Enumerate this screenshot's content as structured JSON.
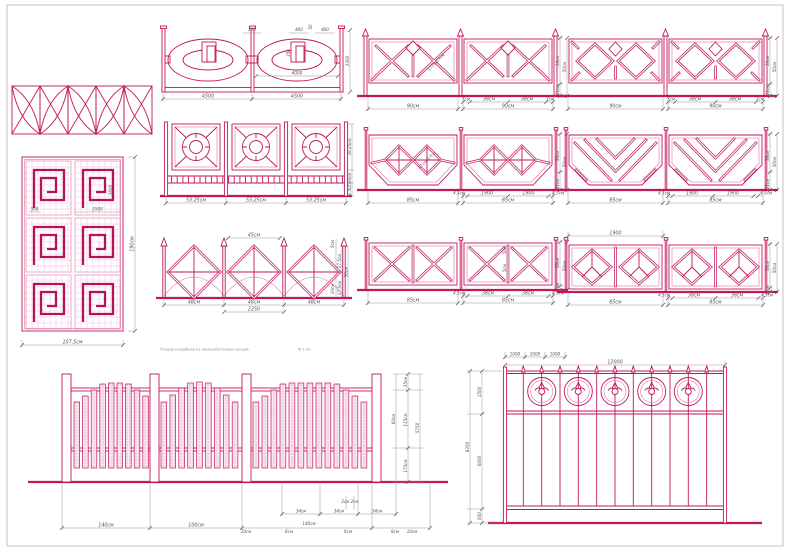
{
  "sheet": {
    "caption": "Ограда усадебная из железобетонных секций",
    "scale": "М 1:10"
  },
  "colors": {
    "primary": "#c2175b",
    "grid": "#eeadca",
    "dimension": "#56505b",
    "hatch_fill": "#dcd6da",
    "stipple_fill": "#f8e7f0"
  },
  "figures": {
    "oval": {
      "top": [
        "200",
        "400",
        "50",
        "400"
      ],
      "inner_vertical": "350",
      "inner_width": "4000",
      "right_height": "2300",
      "bottom": [
        "4500",
        "4500"
      ]
    },
    "circles": {
      "bottom": [
        "53.25см",
        "53.25см",
        "53.25см"
      ],
      "right": [
        "39.25см",
        "6см",
        "12.50см"
      ]
    },
    "diamonds": {
      "top": "45см",
      "right": [
        "5см",
        "27.5см",
        "50см",
        "10см",
        "17.5см"
      ],
      "bottom": [
        "48см",
        "48см",
        "48см"
      ],
      "total": "2250"
    },
    "xcross": {
      "diagonal": "17см/17см",
      "bottom": [
        "7см",
        "38см",
        "38см",
        "7см"
      ],
      "totals": [
        "90см",
        "90см"
      ],
      "right": [
        "38см",
        "11см",
        "50см"
      ]
    },
    "bigdiamond": {
      "bottom": [
        "7см",
        "38см",
        "38см",
        "7см"
      ],
      "totals": [
        "90см",
        "90см"
      ],
      "right": [
        "38см",
        "11см",
        "50см"
      ]
    },
    "hexdiamond": {
      "diagonal": "17см/17см",
      "bottom": [
        "4.5см",
        "1900",
        "1900",
        "4.5см"
      ],
      "totals": [
        "85см",
        "85см"
      ],
      "right": [
        "38см",
        "11см",
        "50см"
      ]
    },
    "chevron": {
      "bottom": [
        "4.5см",
        "1900",
        "1900",
        "4.5см"
      ],
      "totals": [
        "85см",
        "85см"
      ],
      "right": [
        "38см",
        "11см",
        "50см"
      ]
    },
    "doublex": {
      "inner": [
        "5см",
        "5см"
      ],
      "bottom": [
        "4.5см",
        "38см",
        "38см",
        "4.5см"
      ],
      "totals": [
        "85см",
        "85см"
      ],
      "right": [
        "38см",
        "11см",
        "50см"
      ]
    },
    "diamondy": {
      "top": "1900",
      "bottom": [
        "4.5см",
        "38см",
        "38см",
        "4.5см"
      ],
      "totals": [
        "85см",
        "85см"
      ],
      "right": [
        "38см",
        "11см",
        "50см"
      ]
    },
    "gate": {
      "inner": [
        "500",
        "2500",
        "3600"
      ],
      "bottom": "107.5см",
      "right": "190см"
    },
    "planks": {
      "upper": [
        "34см",
        "34см",
        "34см"
      ],
      "pair": "2см 2см",
      "lower": [
        "140см",
        "100см",
        "10см",
        "6см",
        "140см",
        "6см",
        "8см",
        "10см"
      ],
      "right": [
        "35см",
        "60см",
        "115см",
        "175см",
        "5750"
      ]
    },
    "grille": {
      "top": [
        "1000",
        "1000",
        "1000"
      ],
      "total": "12000",
      "left": [
        "1500",
        "8350",
        "6000",
        "850"
      ]
    }
  }
}
